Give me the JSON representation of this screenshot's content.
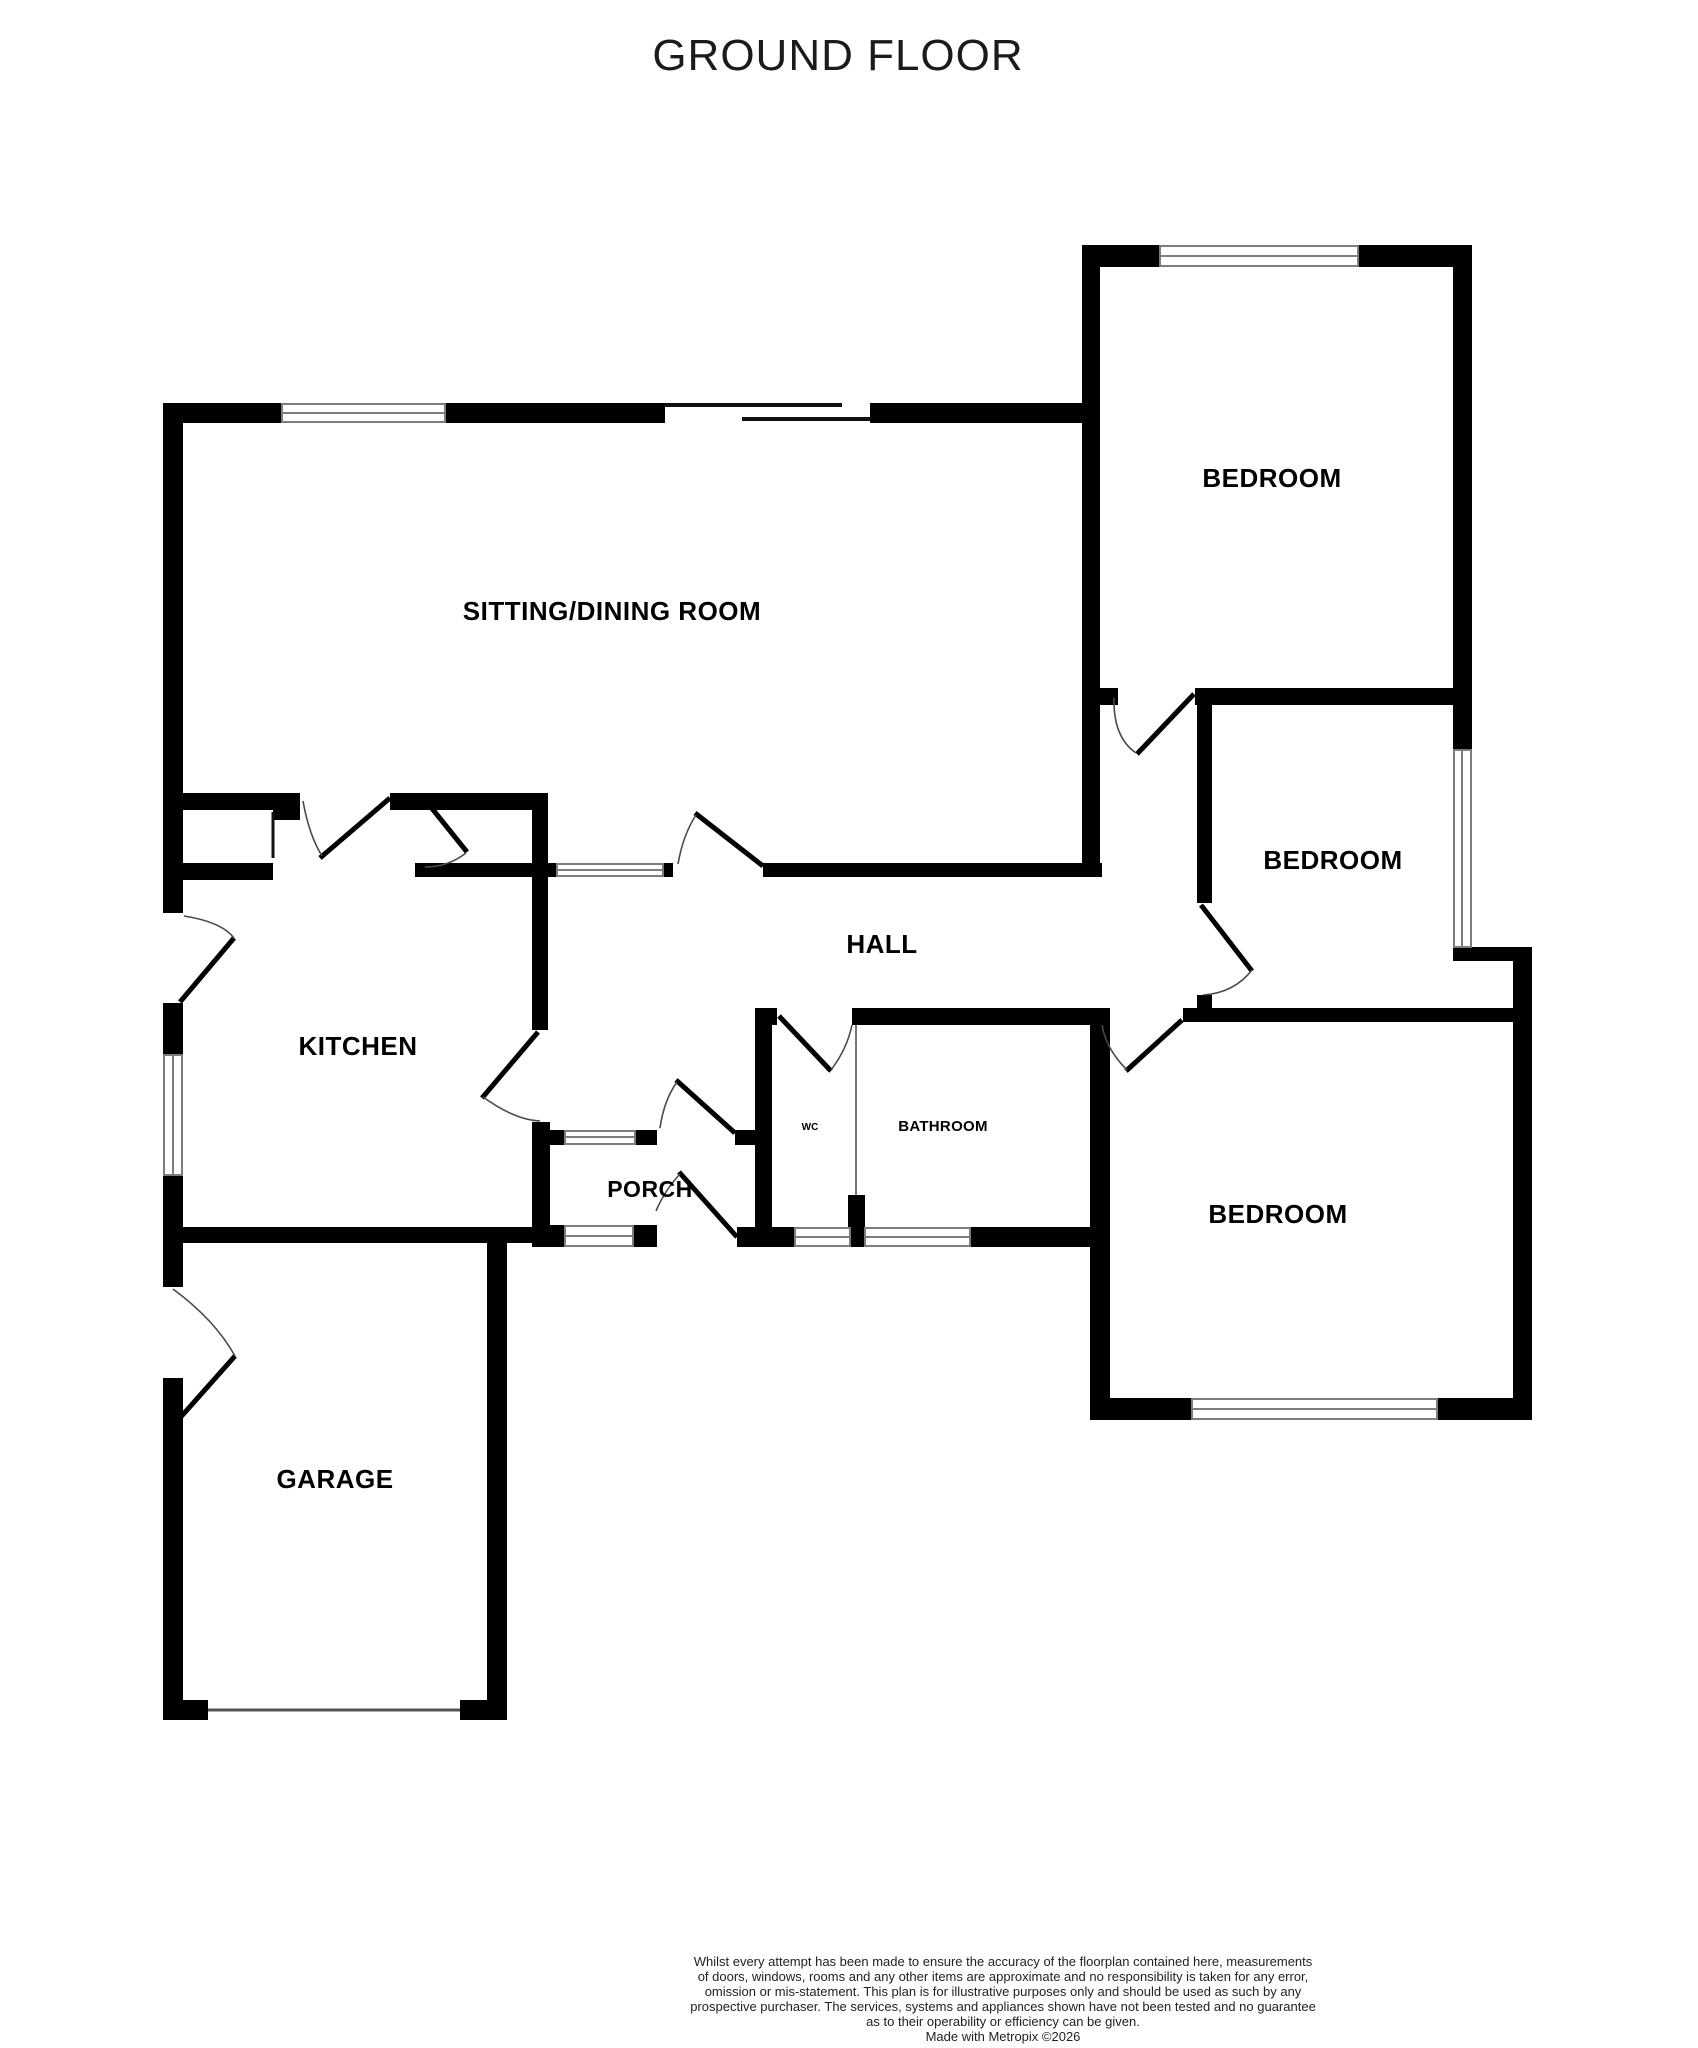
{
  "title": "GROUND FLOOR",
  "rooms": {
    "sitting_dining": "SITTING/DINING ROOM",
    "bedroom_top": "BEDROOM",
    "bedroom_middle": "BEDROOM",
    "bedroom_bottom": "BEDROOM",
    "hall": "HALL",
    "kitchen": "KITCHEN",
    "porch": "PORCH",
    "wc": "WC",
    "bathroom": "BATHROOM",
    "garage": "GARAGE"
  },
  "footer": {
    "lines": [
      "Whilst every attempt has been made to ensure the accuracy of the floorplan contained here, measurements",
      "of doors, windows, rooms and any other items are approximate and no responsibility is taken for any error,",
      "omission or mis-statement. This plan is for illustrative purposes only and should be used as such by any",
      "prospective purchaser. The services, systems and appliances shown have not been tested and no guarantee",
      "as to their operability or efficiency can be given.",
      "Made with Metropix ©2026"
    ]
  },
  "colors": {
    "wall": "#000000",
    "window_line": "#7d7d7d",
    "door_arc": "#4a4a4a",
    "background": "#ffffff",
    "footer_text": "#222222"
  }
}
